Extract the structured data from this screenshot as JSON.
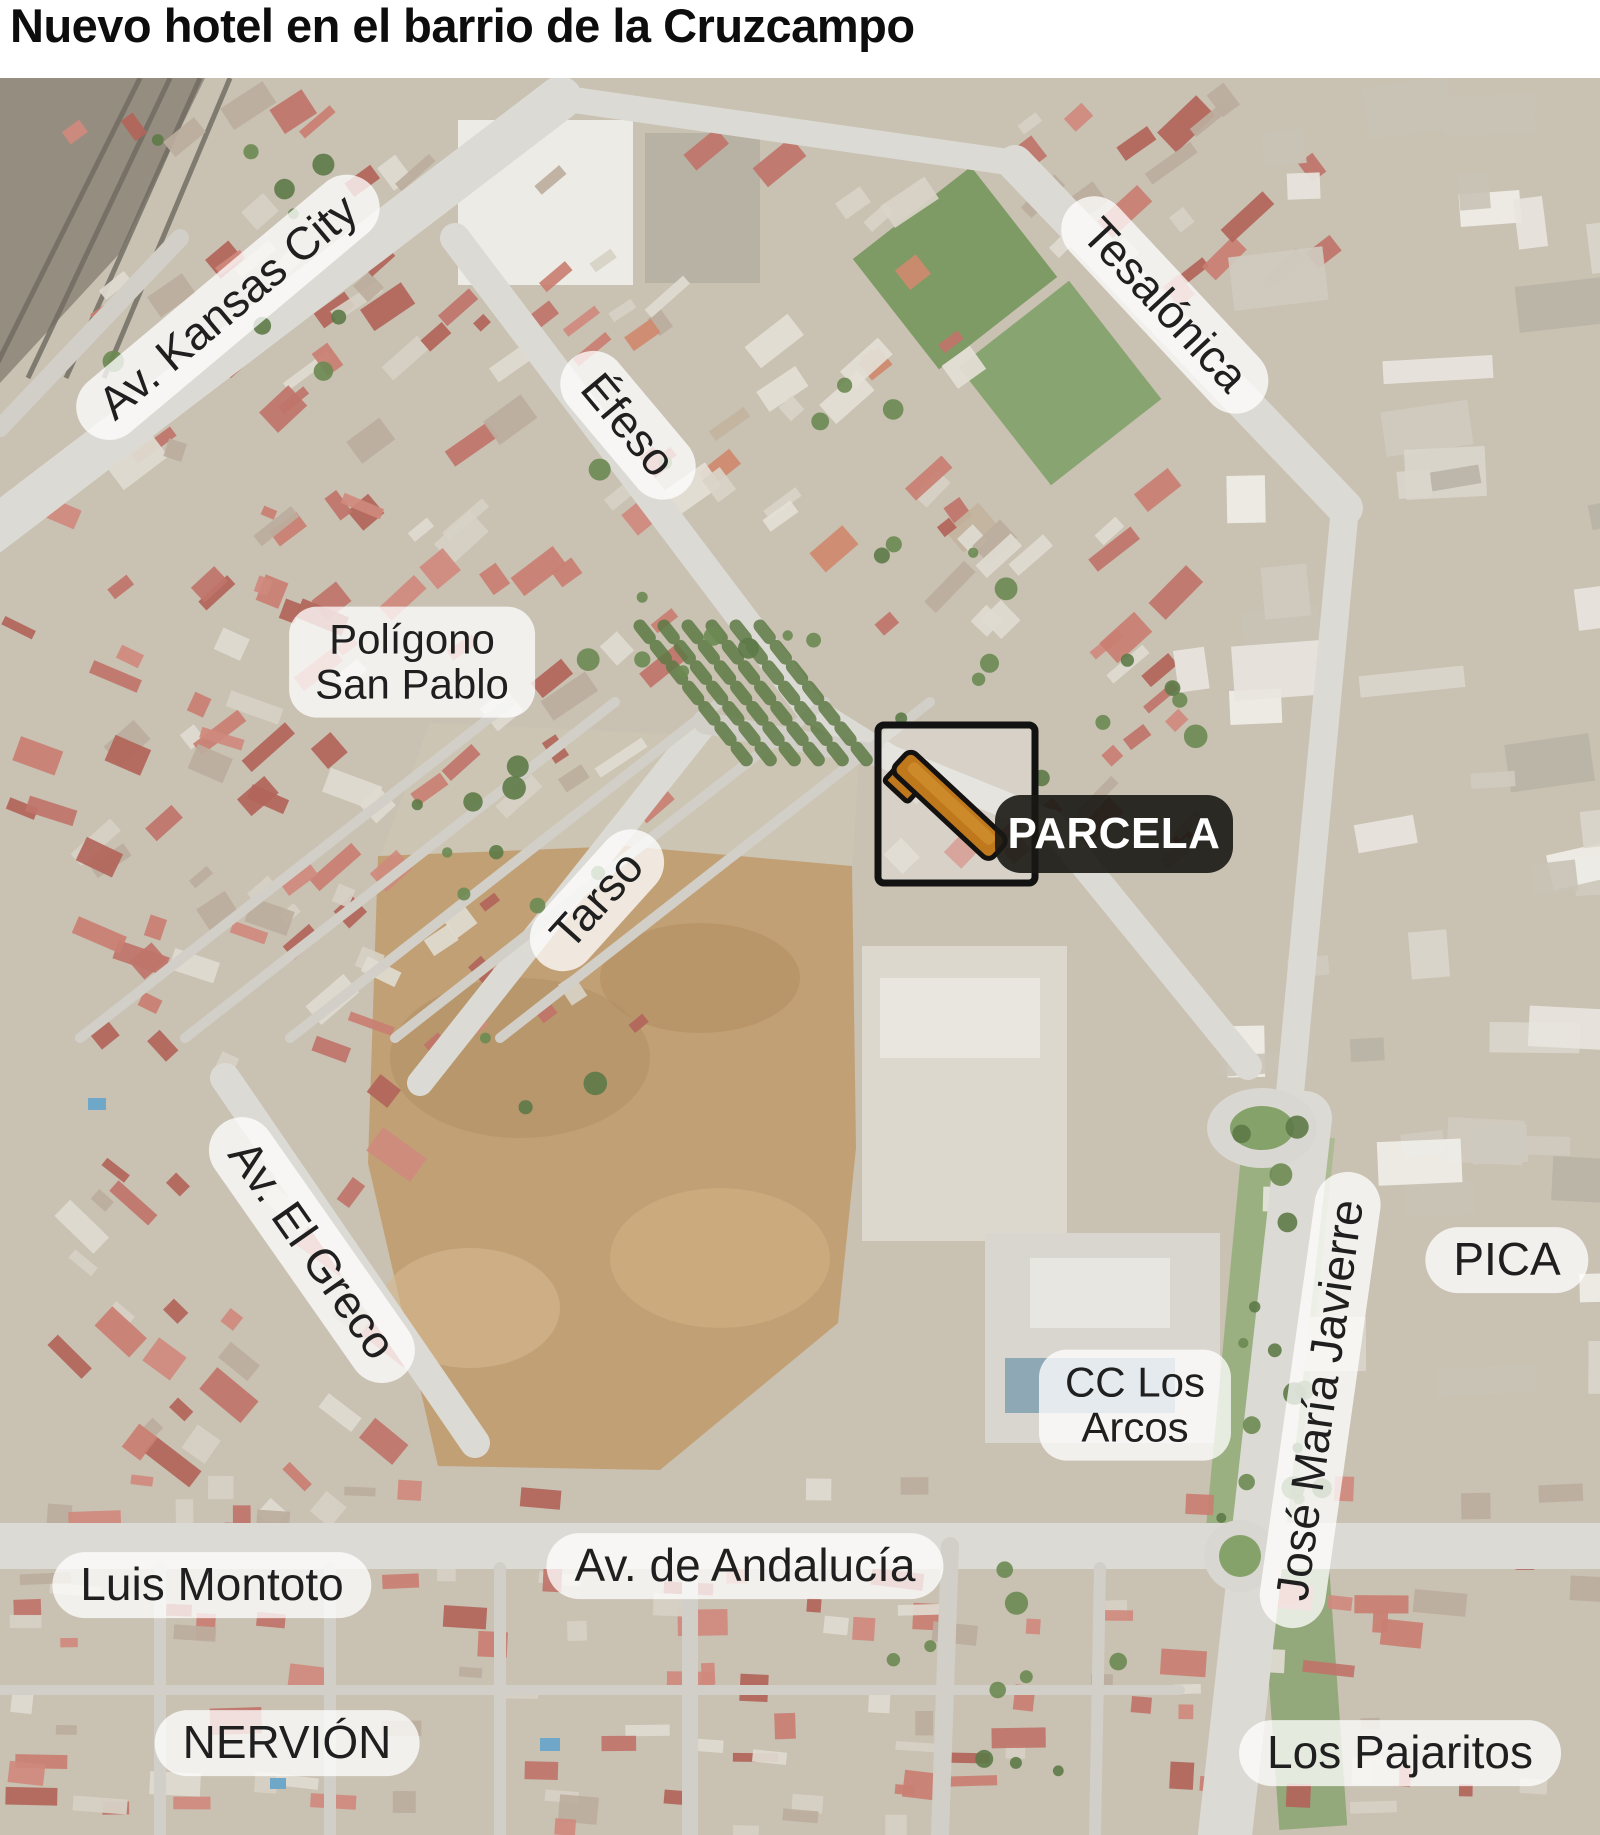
{
  "title": "Nuevo hotel en el barrio de la Cruzcampo",
  "map": {
    "labels": [
      {
        "id": "av-kansas-city",
        "text": "Av. Kansas City",
        "x": 228,
        "y": 229,
        "rot": -40,
        "size": 46
      },
      {
        "id": "tesalonica",
        "text": "Tesalónica",
        "x": 1165,
        "y": 227,
        "rot": 47,
        "size": 46
      },
      {
        "id": "efeso",
        "text": "Éfeso",
        "x": 628,
        "y": 347,
        "rot": 50,
        "size": 46
      },
      {
        "id": "poligono-san-pablo",
        "lines": [
          "Polígono",
          "San Pablo"
        ],
        "x": 412,
        "y": 584,
        "rot": 0,
        "size": 42
      },
      {
        "id": "tarso",
        "text": "Tarso",
        "x": 597,
        "y": 822,
        "rot": -48,
        "size": 46
      },
      {
        "id": "av-el-greco",
        "text": "Av. El Greco",
        "x": 312,
        "y": 1172,
        "rot": 55,
        "size": 46
      },
      {
        "id": "pica",
        "text": "PICA",
        "x": 1507,
        "y": 1182,
        "rot": 0,
        "size": 46
      },
      {
        "id": "cc-los-arcos",
        "lines": [
          "CC Los",
          "Arcos"
        ],
        "x": 1135,
        "y": 1327,
        "rot": 0,
        "size": 42
      },
      {
        "id": "jose-maria-javierre",
        "text": "José María Javierre",
        "x": 1320,
        "y": 1322,
        "rot": -82,
        "size": 46
      },
      {
        "id": "luis-montoto",
        "text": "Luis Montoto",
        "x": 212,
        "y": 1507,
        "rot": 0,
        "size": 46
      },
      {
        "id": "av-de-andalucia",
        "text": "Av. de Andalucía",
        "x": 745,
        "y": 1488,
        "rot": 0,
        "size": 46
      },
      {
        "id": "nervion",
        "text": "NERVIÓN",
        "x": 287,
        "y": 1665,
        "rot": 0,
        "size": 46
      },
      {
        "id": "los-pajaritos",
        "text": "Los Pajaritos",
        "x": 1400,
        "y": 1675,
        "rot": 0,
        "size": 46
      }
    ],
    "parcel": {
      "label": "PARCELA",
      "box": {
        "x": 878,
        "y": 647,
        "w": 157,
        "h": 158
      },
      "badge": {
        "x": 995,
        "y": 717,
        "w": 238,
        "h": 78
      }
    },
    "colors": {
      "pill_bg": "rgba(255,255,255,0.76)",
      "pill_text": "#1f1f1f",
      "badge_bg": "rgba(26,24,20,0.9)",
      "badge_text": "#ffffff",
      "box_border": "#121212",
      "parcel_fill": "#c0781c",
      "parcel_outline": "#141210"
    }
  }
}
